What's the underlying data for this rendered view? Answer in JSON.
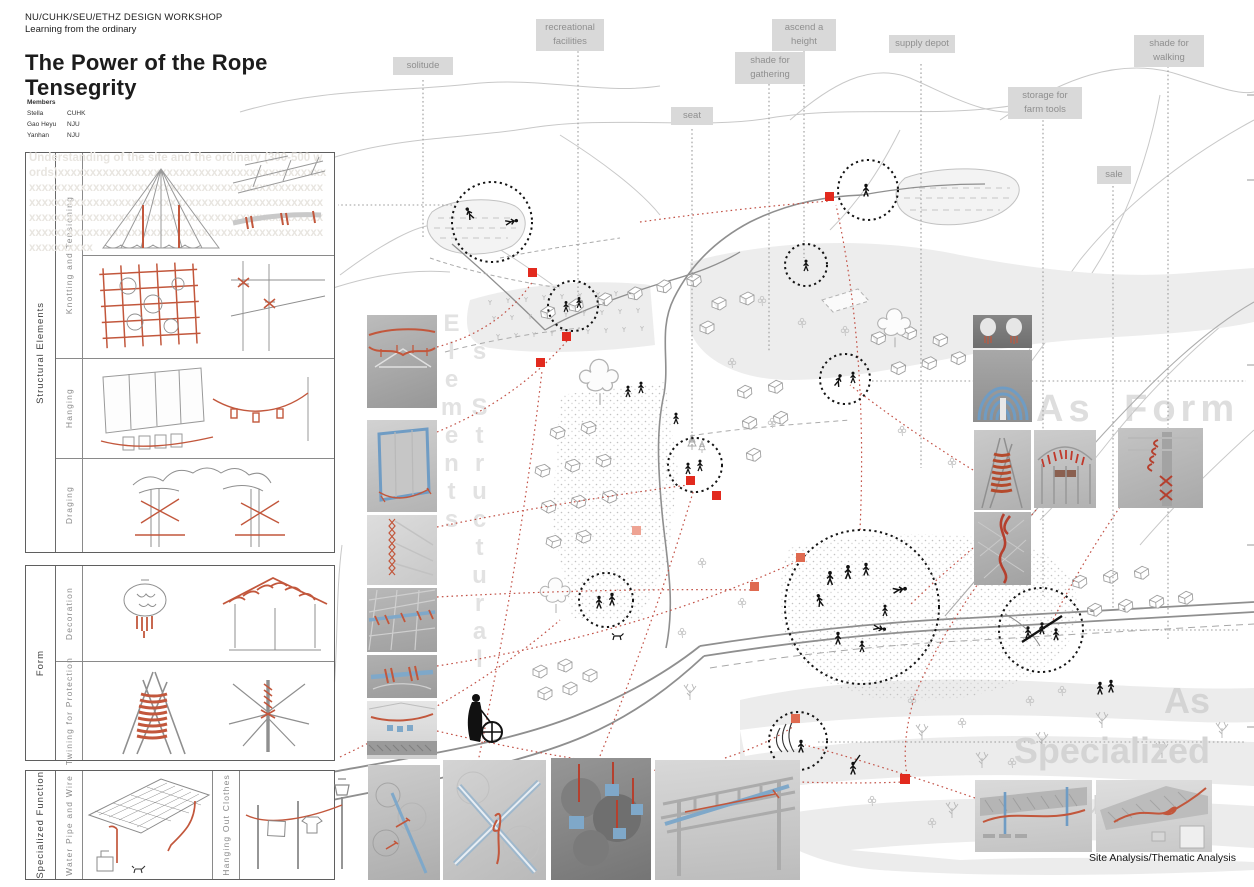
{
  "header": {
    "workshop": "NU/CUHK/SEU/ETHZ DESIGN WORKSHOP",
    "subtitle": "Learning from the ordinary",
    "title_line1": "The Power of the Rope",
    "title_line2": "Tensegrity",
    "members_label": "Members",
    "members": [
      {
        "name": "Stella",
        "affiliation": "CUHK"
      },
      {
        "name": "Gao Heyu",
        "affiliation": "NJU"
      },
      {
        "name": "Yanhan",
        "affiliation": "NJU"
      }
    ]
  },
  "panels": {
    "placeholder": "Understanding of the site and the ordinary (300-500 words)xxxxxxxxxxxxxxxxxxxxxxxxxxxxxxxxxxxxxxxxxxxxxxxxxxxxxxxxxxxxxxxxxxxxxxxxxxxxxxxxxxxxxxxxxxxxxxxxxxxxxxxxxxxxxxxxxxxxxxxxxxxxxxxxxxxxxxxxxxxxxxxxxxxxxxxxxxxxxxxxxxxxxxxxxxxxxxxxxxxxxxxxxxxxxxxxxxxxxxxxxxxxxxxxxxxxxxxxxxxxxxxxxxxxxxxxxxxx",
    "structural": {
      "group": "Structural Elements",
      "row1": "Knotting and Tensioning",
      "row2": "Hanging",
      "row3": "Draging"
    },
    "form": {
      "group": "Form",
      "row1": "Decoration",
      "row2": "Twining for Protection"
    },
    "specialized": {
      "group": "Specialized Function",
      "row1": "Water Pipe and Wire",
      "row2": "Hanging Out Clothes"
    }
  },
  "map": {
    "labels": [
      {
        "text": "solitude"
      },
      {
        "text": "recreational facilities"
      },
      {
        "text": "seat"
      },
      {
        "text": "shade for gathering"
      },
      {
        "text": "ascend a height"
      },
      {
        "text": "supply depot"
      },
      {
        "text": "storage for farm tools"
      },
      {
        "text": "shade for walking"
      },
      {
        "text": "sale"
      }
    ]
  },
  "watermarks": {
    "structural": "As Structural Elements",
    "form": "As Form",
    "specialized_line1": "As",
    "specialized_line2": "Specialized",
    "specialized_line3": "Function"
  },
  "footer": {
    "caption": "Site Analysis/Thematic Analysis"
  },
  "colors": {
    "accent_red": "#e22a1e",
    "rope_red": "#c2573c",
    "rope_blue": "#7fa8c9",
    "label_bg": "#d9d9d9",
    "label_text": "#8f8f8f",
    "watermark_gray": "#e0e0e0"
  }
}
